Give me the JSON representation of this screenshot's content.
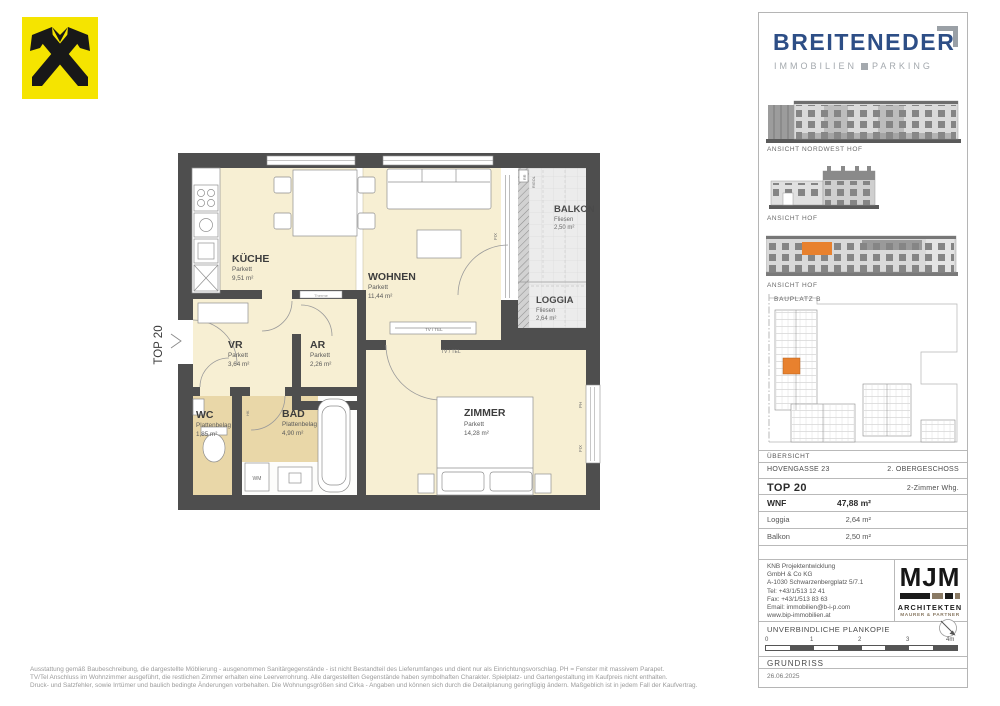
{
  "brand": {
    "name": "BREITENEDER",
    "tagline_left": "IMMOBILIEN",
    "tagline_right": "PARKING",
    "blue": "#2d4e86",
    "gray": "#a4a9ae"
  },
  "floorplan": {
    "unit_label": "TOP 20",
    "rooms": [
      {
        "name": "KÜCHE",
        "floor": "Parkett",
        "area": "9,51 m²"
      },
      {
        "name": "WOHNEN",
        "floor": "Parkett",
        "area": "11,44 m²"
      },
      {
        "name": "BALKON",
        "floor": "Fliesen",
        "area": "2,50 m²"
      },
      {
        "name": "LOGGIA",
        "floor": "Fliesen",
        "area": "2,64 m²"
      },
      {
        "name": "VR",
        "floor": "Parkett",
        "area": "3,64 m²"
      },
      {
        "name": "AR",
        "floor": "Parkett",
        "area": "2,26 m²"
      },
      {
        "name": "WC",
        "floor": "Plattenbelag",
        "area": "1,85 m²"
      },
      {
        "name": "BAD",
        "floor": "Plattenbelag",
        "area": "4,90 m²"
      },
      {
        "name": "ZIMMER",
        "floor": "Parkett",
        "area": "14,28 m²"
      }
    ],
    "annotations": {
      "tv_tel": "TV / TEL",
      "fix": "FIX",
      "ph": "PH",
      "wm": "WM",
      "hk": "HK",
      "rr": "RR",
      "rigol": "RIGOL",
      "therme": "Therme"
    },
    "colors": {
      "wall": "#4e4e4e",
      "room": "#f7efd3",
      "wet_room": "#e9d7a8",
      "outdoor": "#ececec"
    }
  },
  "panel": {
    "elevations": [
      {
        "label": "ANSICHT NORDWEST HOF"
      },
      {
        "label": "ANSICHT HOF"
      },
      {
        "label": "ANSICHT HOF"
      }
    ],
    "siteplan": {
      "label": "BAUPLATZ  B",
      "caption": "ÜBERSICHT"
    },
    "info": {
      "address": "HOVENGASSE 23",
      "storey": "2. OBERGESCHOSS",
      "unit": "TOP 20",
      "unit_type": "2-Zimmer Whg.",
      "rows": [
        {
          "label": "WNF",
          "value": "47,88 m²"
        },
        {
          "label": "Loggia",
          "value": "2,64 m²"
        },
        {
          "label": "Balkon",
          "value": "2,50 m²"
        }
      ]
    },
    "contact": {
      "lines": [
        "KNB Projektentwicklung",
        "GmbH & Co KG",
        "A-1030 Schwarzenbergplatz 5/7.1",
        "Tel: +43/1/513 12 41",
        "Fax: +43/1/513 83 63",
        "Email: immobilien@b-i-p.com",
        "www.bip-immobilien.at"
      ]
    },
    "architects": {
      "logo": "MJM",
      "line1": "ARCHITEKTEN",
      "line2": "MAURER & PARTNER"
    },
    "plankopie": "UNVERBINDLICHE PLANKOPIE",
    "scale_ticks": [
      "0",
      "1",
      "2",
      "3",
      "4m"
    ],
    "drawing_type": "GRUNDRISS",
    "date": "26.06.2025",
    "highlight_orange": "#e8812e"
  },
  "disclaimer": {
    "lines": [
      "Ausstattung gemäß Baubeschreibung, die dargestellte Möblierung - ausgenommen Sanitärgegenstände - ist nicht Bestandteil des Lieferumfanges und dient nur als Einrichtungsvorschlag. PH = Fenster mit massivem Parapet.",
      "TV/Tel Anschluss im Wohnzimmer ausgeführt, die restlichen Zimmer erhalten eine Leerverrohrung. Alle dargestellten Gegenstände haben symbolhaften Charakter. Spielplatz- und Gartengestaltung im Kaufpreis nicht enthalten.",
      "Druck- und Satzfehler, sowie Irrtümer und baulich bedingte Änderungen vorbehalten. Die Wohnungsgrößen sind Cirka - Angaben und können sich durch die Detailplanung geringfügig ändern. Maßgeblich ist in jedem Fall der Kaufvertrag."
    ]
  }
}
